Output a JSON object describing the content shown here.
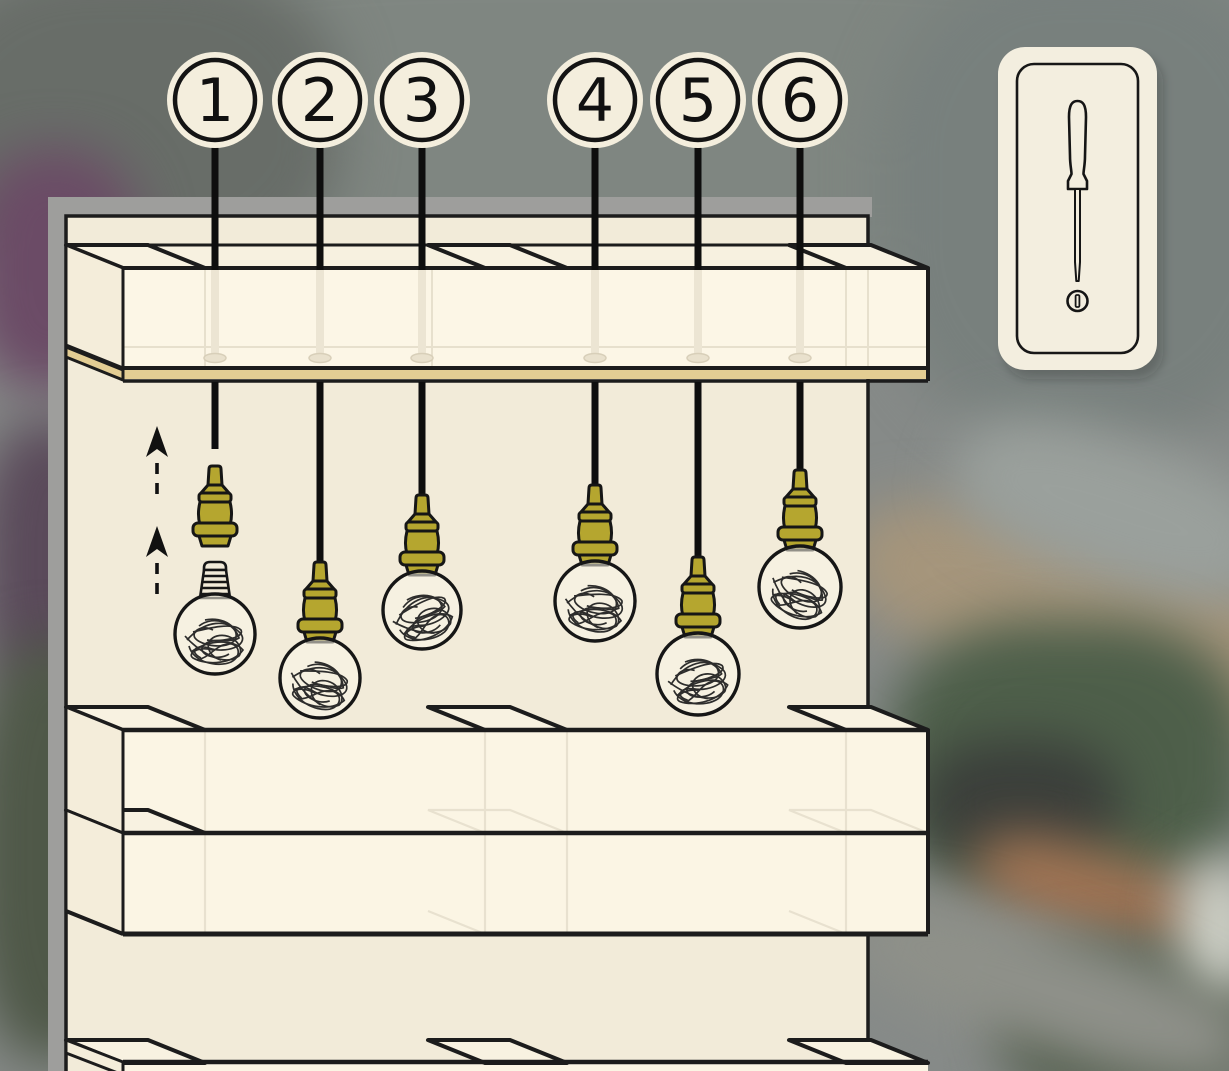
{
  "callouts": [
    {
      "label": "1"
    },
    {
      "label": "2"
    },
    {
      "label": "3"
    },
    {
      "label": "4"
    },
    {
      "label": "5"
    },
    {
      "label": "6"
    }
  ],
  "tool_card": {
    "tool": "flathead screwdriver",
    "fastener": "slotted screw"
  },
  "scene": {
    "pendant_lamps": 6,
    "exploded_lamp_callout": "1",
    "shelf_rows_visible": 4
  },
  "colors": {
    "cream_panel": "#f2ebd9",
    "cream_bright": "#fcf6e6",
    "board_tan": "#e3cd93",
    "socket_olive": "#b5a62f",
    "backing_gray": "#9e9e9c",
    "outline_black": "#1a1a1a"
  }
}
